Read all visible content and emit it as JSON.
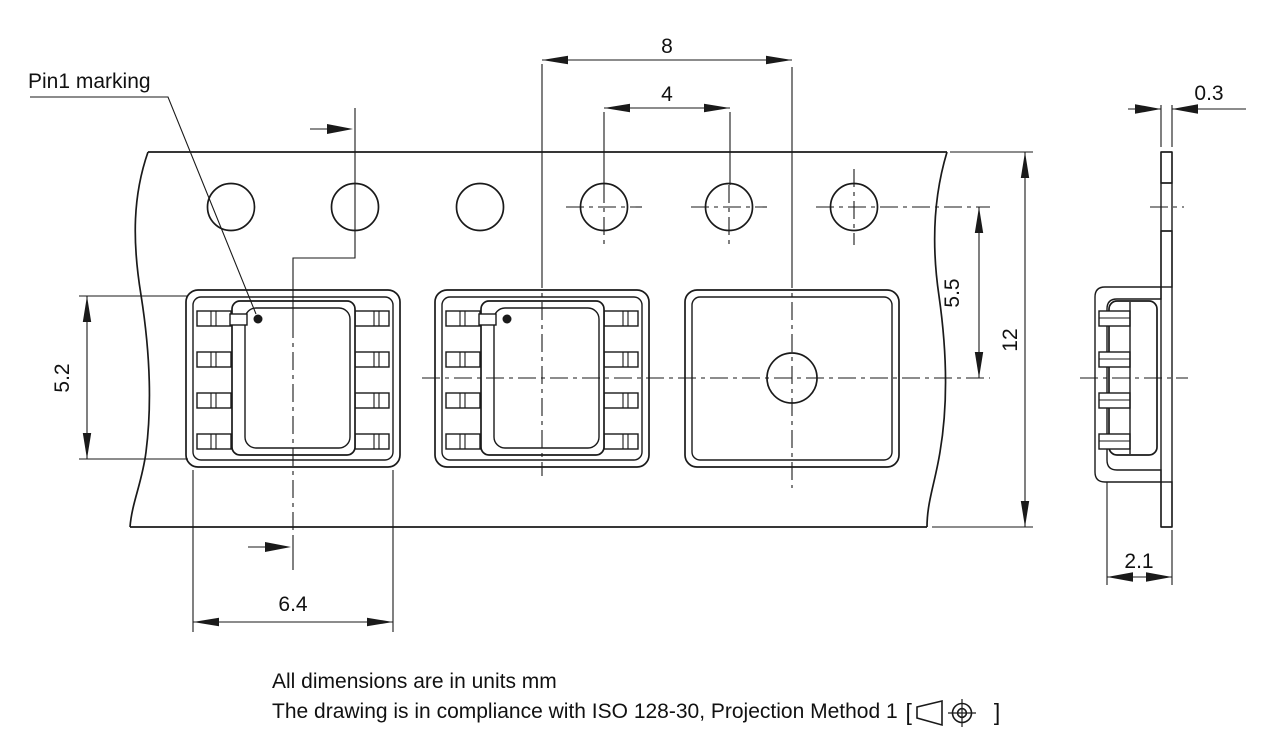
{
  "drawing": {
    "labels": {
      "pin1_marking": "Pin1 marking"
    },
    "dimensions": {
      "pocket_pitch": "8",
      "sprocket_hole_pitch": "4",
      "tape_thickness": "0.3",
      "hole_to_pocket_center": "5.5",
      "tape_width": "12",
      "cavity_length": "5.2",
      "cavity_width": "6.4",
      "pocket_depth": "2.1"
    },
    "notes": {
      "line1": "All dimensions are in units mm",
      "line2_prefix": "The drawing is in compliance with ISO 128-30, Projection Method 1 ",
      "bracket_open": "[",
      "bracket_close": "]"
    },
    "colors": {
      "line": "#1a1a1a",
      "background": "#ffffff"
    }
  }
}
